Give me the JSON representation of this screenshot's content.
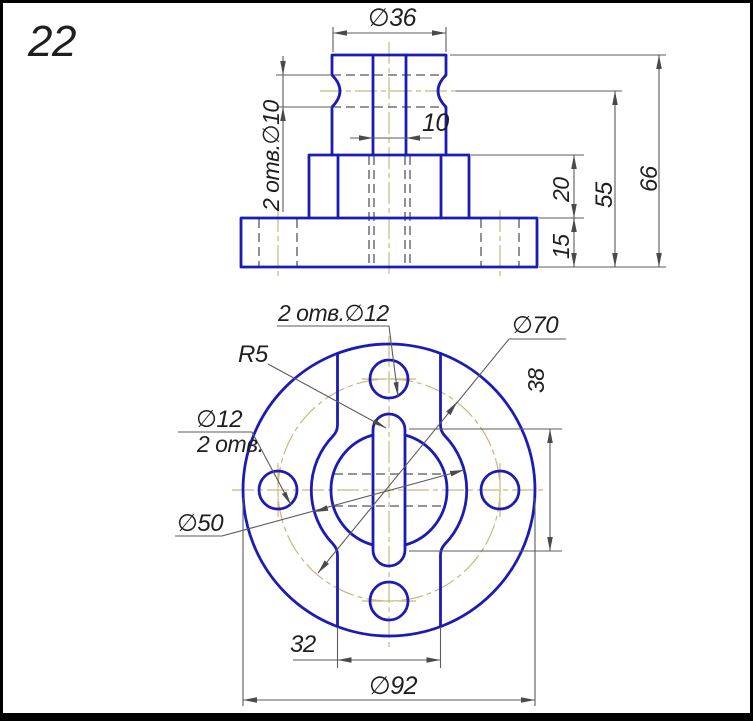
{
  "sheet": {
    "number": "22",
    "type": "technical-drawing"
  },
  "colors": {
    "outline_blue": "#1b1bb5",
    "thin_line": "#5b5b5b",
    "center_line_tan": "#c9b87a",
    "text": "#1f1f1f",
    "background": "#ffffff",
    "frame": "#000000"
  },
  "front_view": {
    "dims": {
      "top_diameter": "∅36",
      "slot_width": "10",
      "side_holes": "2 отв.∅10",
      "flange_height": "15",
      "boss_height": "20",
      "neck_height": "55",
      "total_height": "66"
    }
  },
  "plan_view": {
    "dims": {
      "top_holes": "2 отв.∅12",
      "slot_end_radius": "R5",
      "bolt_circle_diameter": "∅70",
      "slot_length": "38",
      "left_hole_diameter": "∅12",
      "left_hole_count": "2 отв.",
      "boss_diameter": "∅50",
      "strip_width": "32",
      "outer_diameter": "∅92"
    }
  }
}
